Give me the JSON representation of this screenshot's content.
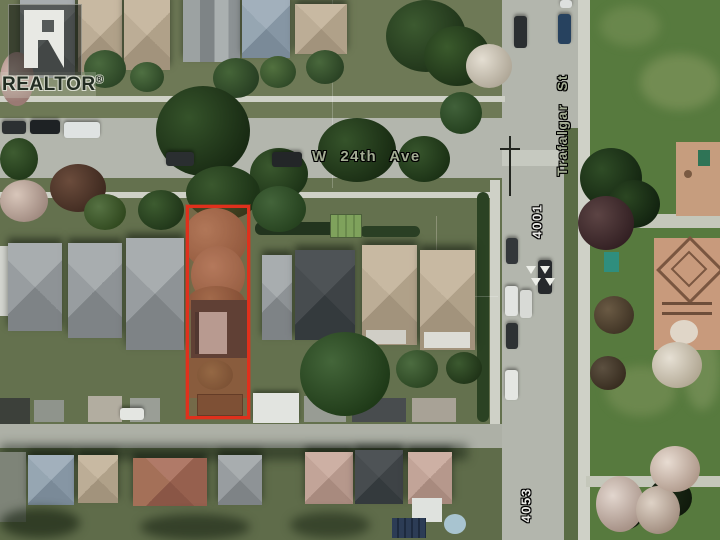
{
  "watermark": {
    "logo_letter": "R",
    "brand": "REALTOR",
    "registered_symbol": "®"
  },
  "labels": {
    "street_horizontal": "W 24th Ave",
    "street_vertical": "Trafalgar St",
    "lot_number_north": "4001",
    "lot_number_south": "4053"
  },
  "colors": {
    "property_outline": "#e0301c",
    "street_label_text": "#a3ac93",
    "lot_number_text": "#e9e9e5",
    "road": "#b3b6ad",
    "park_grass": "#577a3e"
  }
}
